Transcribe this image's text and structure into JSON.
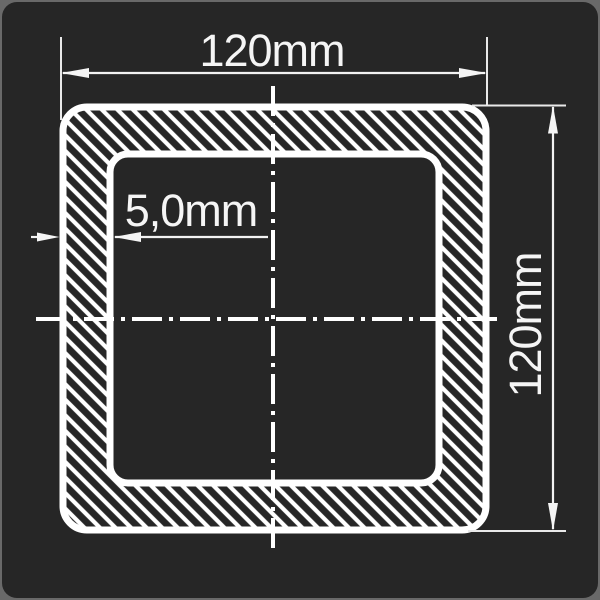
{
  "drawing": {
    "type": "square-hollow-section-cross-section",
    "width_label": "120mm",
    "height_label": "120mm",
    "wall_thickness_label": "5,0mm"
  },
  "colors": {
    "page_background": "#696969",
    "card_background": "#262626",
    "line_and_text": "#ffffff"
  }
}
